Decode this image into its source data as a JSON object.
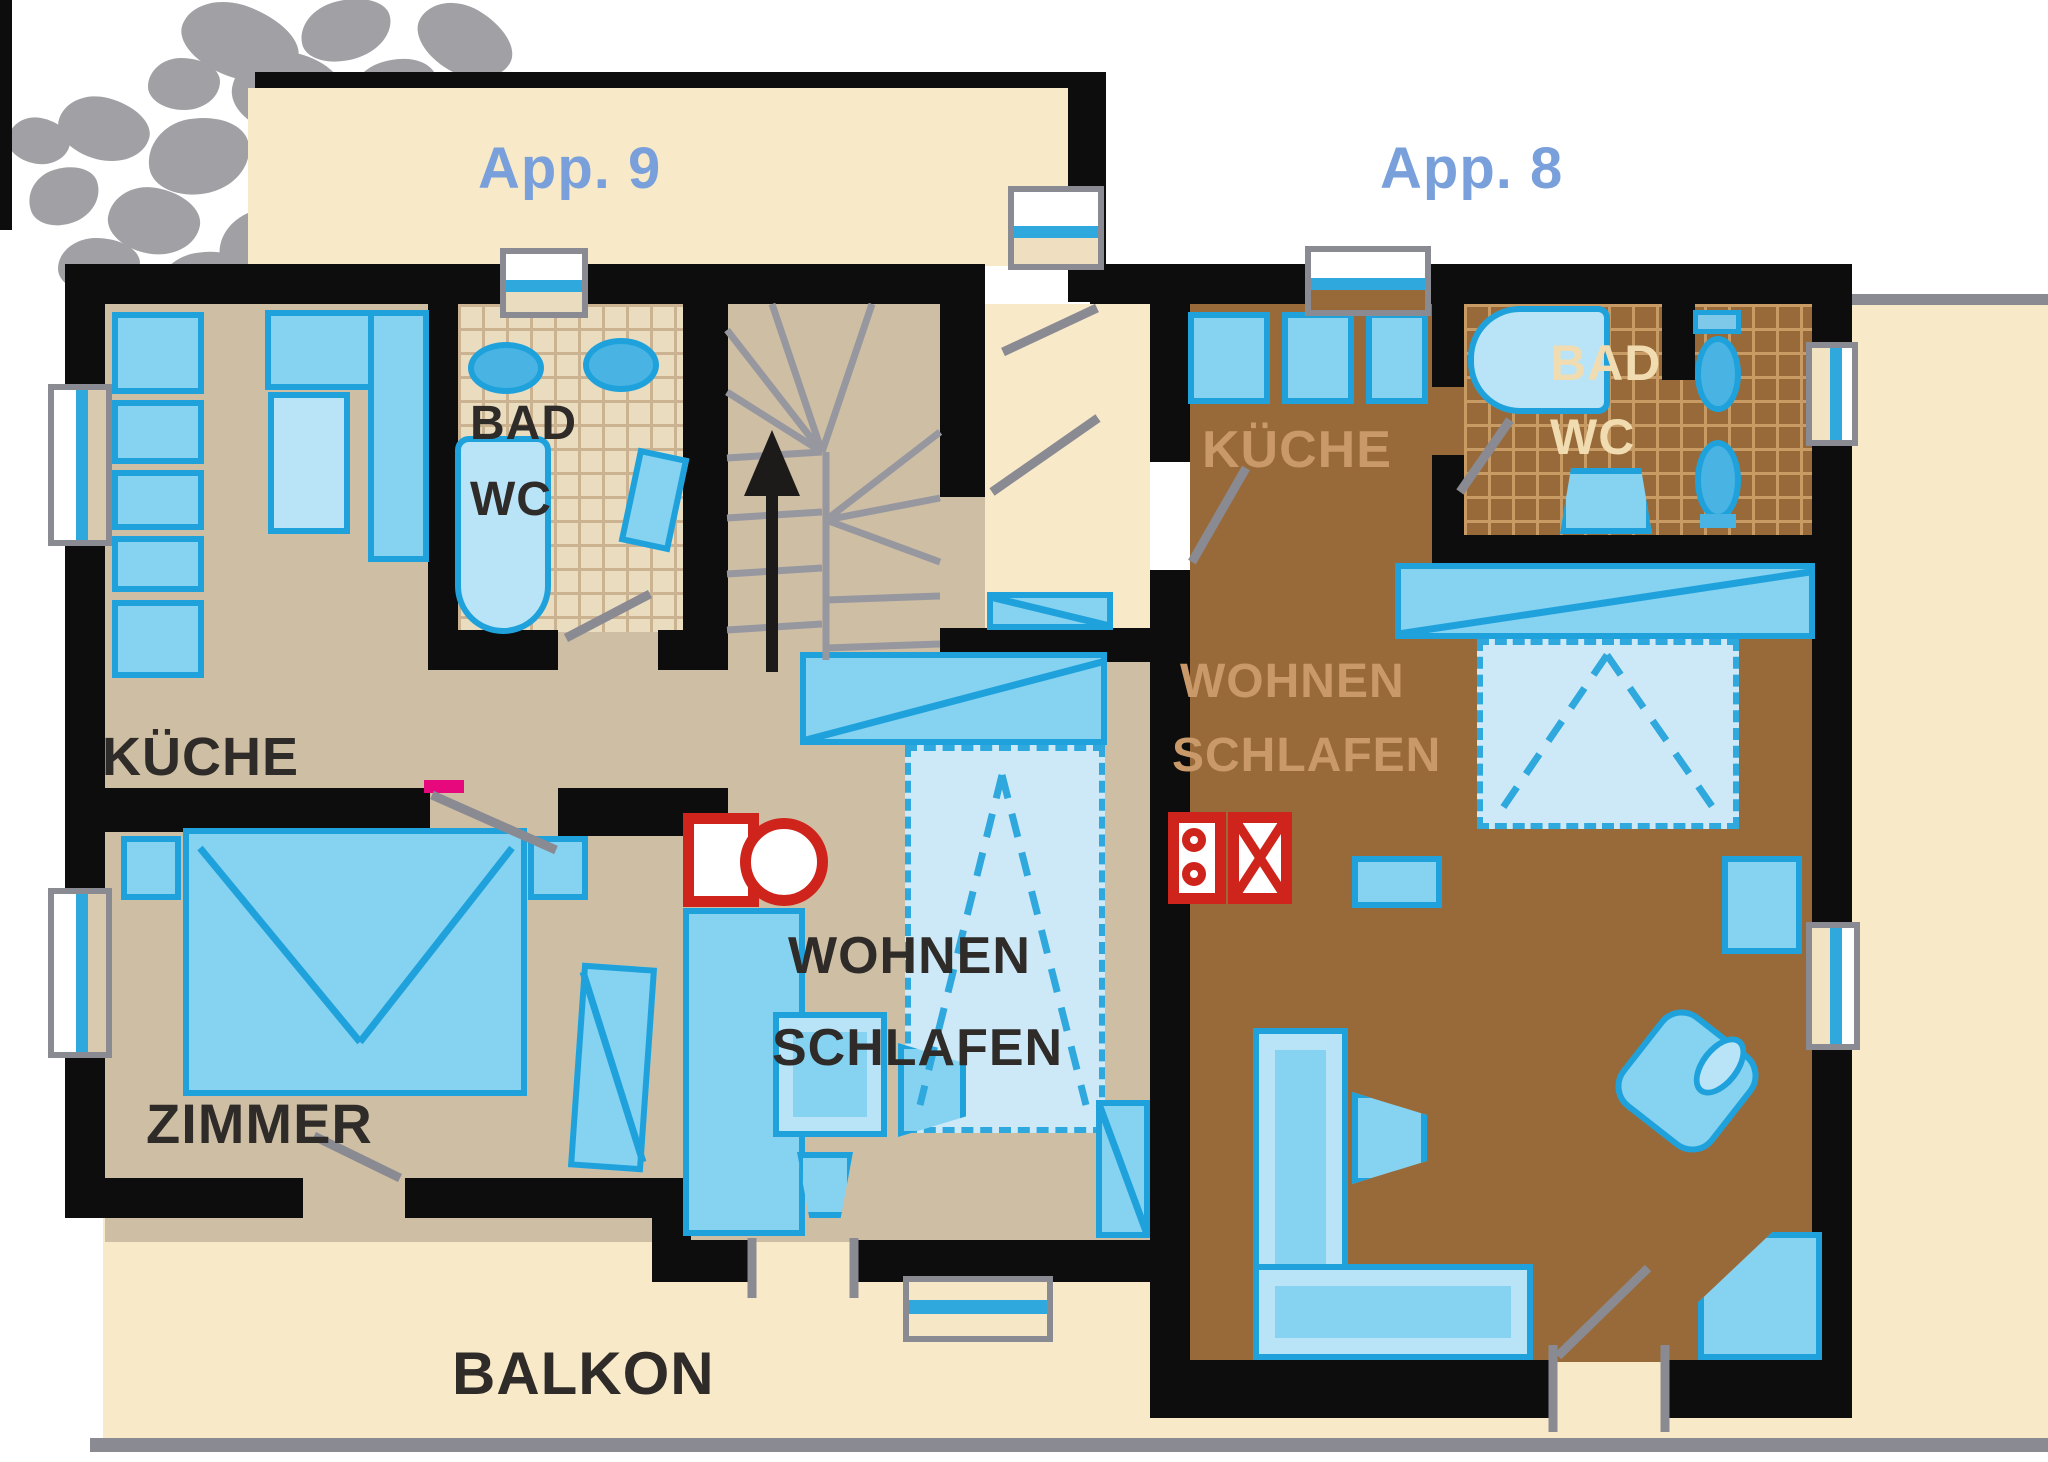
{
  "apartments": {
    "app9": {
      "label": "App. 9",
      "rooms": {
        "kueche": "KÜCHE",
        "bad": "BAD",
        "wc": "WC",
        "zimmer": "ZIMMER",
        "wohnen": "WOHNEN",
        "schlafen": "SCHLAFEN"
      }
    },
    "app8": {
      "label": "App. 8",
      "rooms": {
        "kueche": "KÜCHE",
        "bad": "BAD",
        "wc": "WC",
        "wohnen": "WOHNEN",
        "schlafen": "SCHLAFEN"
      }
    }
  },
  "outdoor": {
    "balkon": "BALKON"
  },
  "icons": [
    "stove-icon",
    "oven-icon",
    "sink-icon",
    "bathtub-icon",
    "toilet-icon",
    "bidet-icon",
    "shower-icon",
    "stairs-up-arrow-icon",
    "door-swing-icon",
    "window-icon",
    "sofa-icon",
    "bed-icon",
    "wardrobe-icon",
    "table-icon",
    "chair-icon",
    "armchair-icon",
    "stones-decoration-icon"
  ],
  "colors": {
    "wall": "#0d0d0d",
    "floor_app9": "#cebea4",
    "floor_app8": "#996a39",
    "outdoor_cream": "#f8e9c8",
    "furniture_blue": "#85d2f1",
    "furniture_border_blue": "#1fa2dc",
    "pullout_bed_fill": "#cde9f8",
    "stove_red": "#cf241c",
    "door_gray": "#8a8a92",
    "label_dark": "#2e2b28",
    "label_app_blue": "#7aa0dc",
    "label_app8_tan": "#c9996a",
    "label_bath8_cream": "#f0dcb0",
    "accent_magenta": "#e8087e",
    "stones_gray": "#a1a1a5",
    "tile9_base": "#eadcbf",
    "tile9_grid": "#cbb291",
    "tile8_grid": "#c79b63"
  }
}
